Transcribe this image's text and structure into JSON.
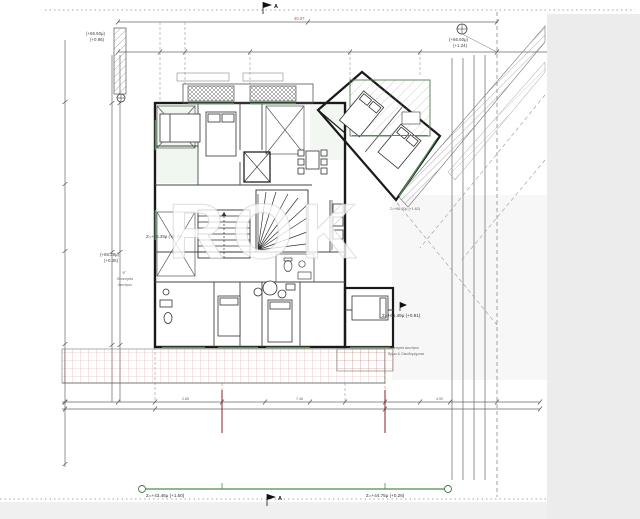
{
  "drawing": {
    "watermark": "ROK",
    "section_marker": "A",
    "top_dim_label": "40.07",
    "top_right_elev": [
      "(+66.50μ)",
      "(+1.24)"
    ],
    "top_left_elev": [
      "(+65.50μ)",
      "(+0.96)"
    ],
    "left_elev": [
      "(+65.39μ)",
      "(+0.35)"
    ],
    "z_label": "Z=+65.39μ (+0.38)",
    "right_elev": "Σ=+65.49μ (+0.91)",
    "wing_elev": "Σ=+66.20μ (+1.62)",
    "bottom_left_elev": "Σ=+43.46μ (+1.50)",
    "bottom_right_elev": "Σ=+44.75μ (+0.26)",
    "left_note": [
      "ΥΓ",
      "Ιδιοκτησία",
      "Ακινήτου"
    ],
    "right_note": [
      "Ιδιοκτησία Ακινήτου",
      "Άρμα & Οικοδομήματα"
    ],
    "bottom_dims": [
      "2.85",
      "7.45",
      "4.90"
    ],
    "colors": {
      "walls": "#1a1a1a",
      "windows": "#4f8f4f",
      "terrace_grid": "#c07868",
      "section_cut": "#8b2020",
      "dim_red": "#c04848",
      "margin_gray": "#ececec"
    }
  }
}
